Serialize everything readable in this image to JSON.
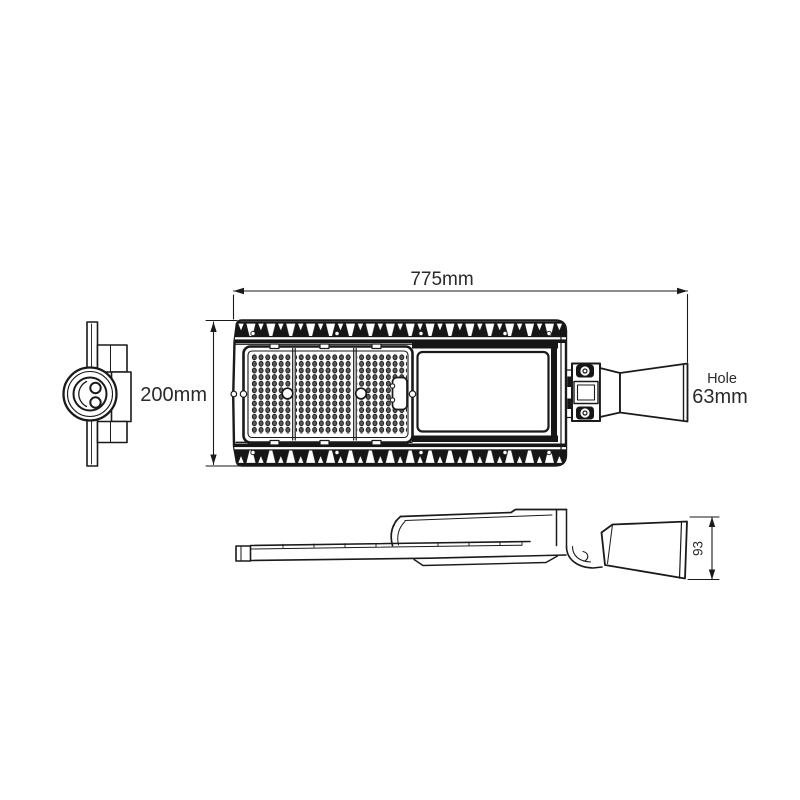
{
  "drawing": {
    "dim_length": "775mm",
    "dim_height": "200mm",
    "hole_label": "Hole",
    "hole_size": "63mm",
    "dim_arm_height": "93"
  },
  "colors": {
    "ink": "#1a1a1a",
    "background": "#ffffff",
    "led_dot": "#5a5a5a"
  }
}
